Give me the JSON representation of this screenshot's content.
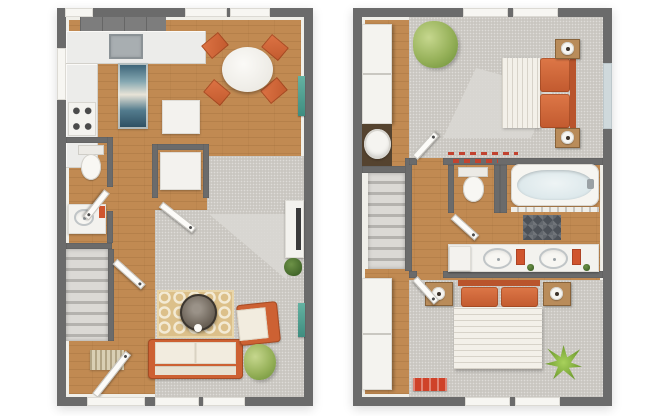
{
  "palette": {
    "background": "#ffffff",
    "wall": "#6b6b6b",
    "trim_white": "#f0efe9",
    "wood_floor": "#c18a52",
    "carpet_gray": "#c9c6c0",
    "counter_white": "#ececea",
    "cabinet_gray": "#7d7d7d",
    "accent_orange": "#d2663a",
    "orange_dark": "#b9542c",
    "cushion_cream": "#f2ecdf",
    "rug_blue": "#355d72",
    "rug_tan": "#dcc08a",
    "rug_red": "#cf4229",
    "plant_green": "#96b159",
    "plant_bright": "#8fc34a",
    "tub_water": "#d5e3e7",
    "bath_mat": "#4c5158",
    "wall_art_teal": "#4f9f90"
  },
  "floors": [
    {
      "name": "first-floor",
      "rooms": [
        "kitchen",
        "dining-area",
        "living-room",
        "half-bath",
        "entry",
        "staircase",
        "pantry-closet"
      ]
    },
    {
      "name": "second-floor",
      "rooms": [
        "bedroom-1",
        "bathroom",
        "bedroom-2",
        "laundry-closet",
        "hallway",
        "staircase",
        "wardrobe-closet"
      ]
    }
  ],
  "labels": {
    "plan_first": "First floor plan",
    "plan_second": "Second floor plan",
    "kitchen_counter": "Kitchen counter",
    "upper_cabinets": "Upper cabinets",
    "sink": "Kitchen sink",
    "stove": "Stove",
    "runner_rug": "Blue runner rug",
    "island": "Kitchen island",
    "pantry": "Pantry closet",
    "appliance": "Closet appliance",
    "dining_table": "Round dining table",
    "dining_chair": "Dining chair",
    "window": "Window",
    "door_opening": "Front door opening",
    "door": "Door",
    "toilet": "Toilet",
    "vanity": "Vanity with sink",
    "towel": "Orange towel",
    "stairs": "Staircase",
    "doormat": "Entry doormat",
    "living_rug": "Patterned area rug",
    "coffee_table": "Round coffee table",
    "sofa": "Sofa with orange frame",
    "armchair": "Armchair with orange frame",
    "plant": "Potted plant",
    "console": "Media console",
    "tv": "Television",
    "wall_art": "Wall art",
    "carpet": "Carpeted floor",
    "laundry_doors": "Closet doors",
    "washer": "Washer",
    "wardrobe": "Wardrobe closet",
    "bed": "Bed",
    "duvet": "White duvet",
    "pillow": "Orange pillow",
    "headboard": "Headboard",
    "nightstand": "Nightstand",
    "lamp": "Table lamp",
    "tub": "Bathtub",
    "bath_mat": "Bath mat",
    "hamper": "Hamper",
    "double_vanity": "Double vanity",
    "red_rug": "Red accent rug",
    "decor_trim": "Red accent trim"
  }
}
